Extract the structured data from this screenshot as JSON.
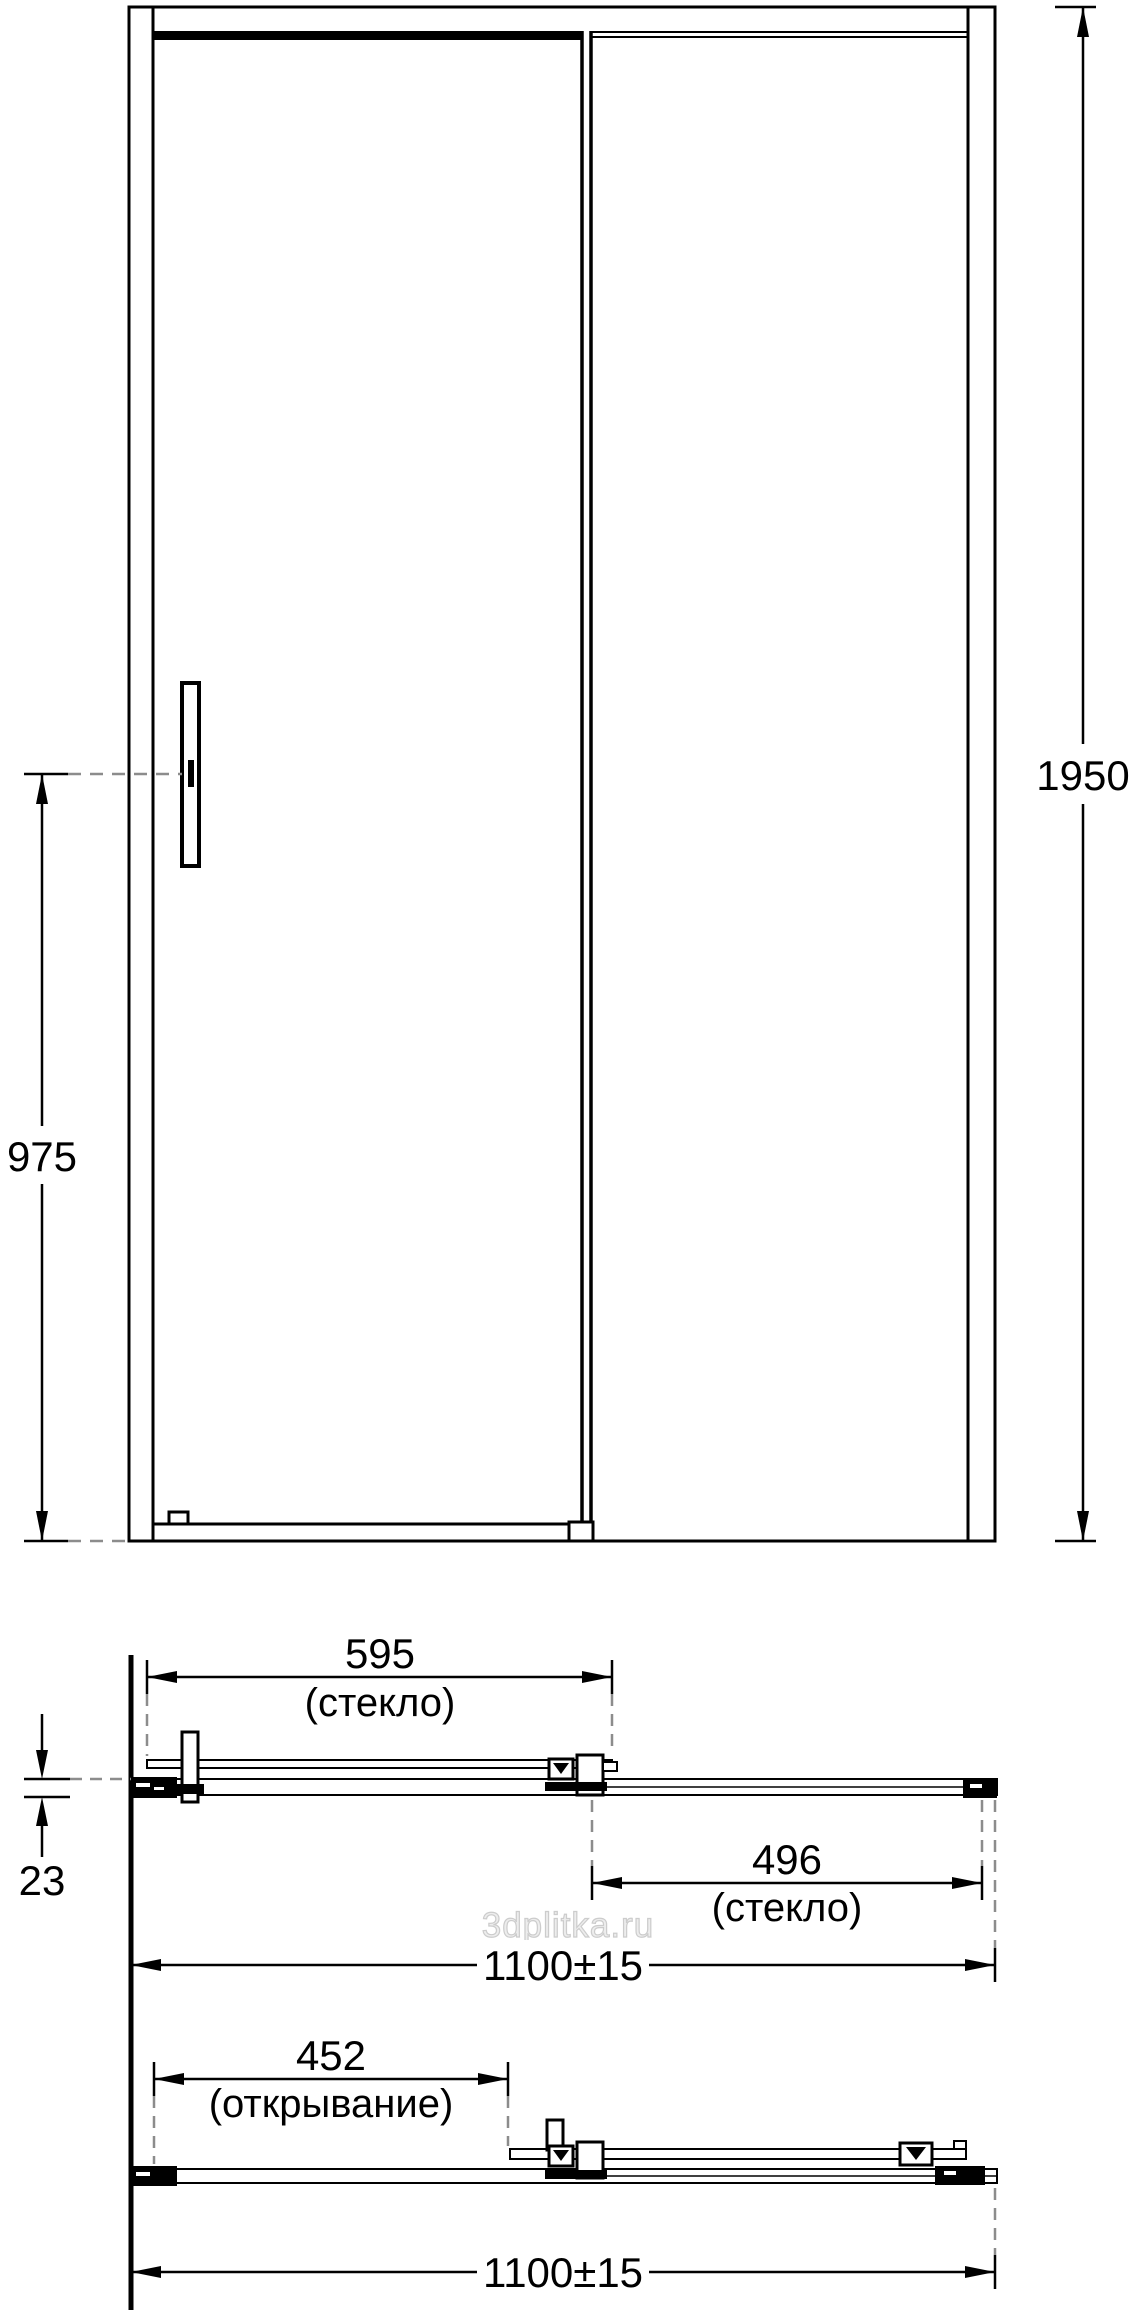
{
  "diagram": {
    "kind": "technical-drawing",
    "subject": "sliding-shower-door",
    "views": {
      "front": "elevation",
      "plan_closed": "horizontal section, door closed",
      "plan_open": "horizontal section, door open"
    },
    "dims": {
      "front_height": {
        "value": "1950"
      },
      "handle_height": {
        "value": "975"
      },
      "glass_door": {
        "value": "595",
        "note": "(стекло)"
      },
      "glass_fixed": {
        "value": "496",
        "note": "(стекло)"
      },
      "profile_depth": {
        "value": "23"
      },
      "overall_width_closed": {
        "value": "1100±15"
      },
      "opening_width": {
        "value": "452",
        "note": "(открывание)"
      },
      "overall_width_open": {
        "value": "1100±15"
      }
    },
    "watermark": {
      "text": "3dplitka.ru"
    },
    "colors": {
      "line": "#000000",
      "dashed": "#8c8c8c",
      "watermark": "#ededed",
      "background": "#ffffff"
    }
  }
}
